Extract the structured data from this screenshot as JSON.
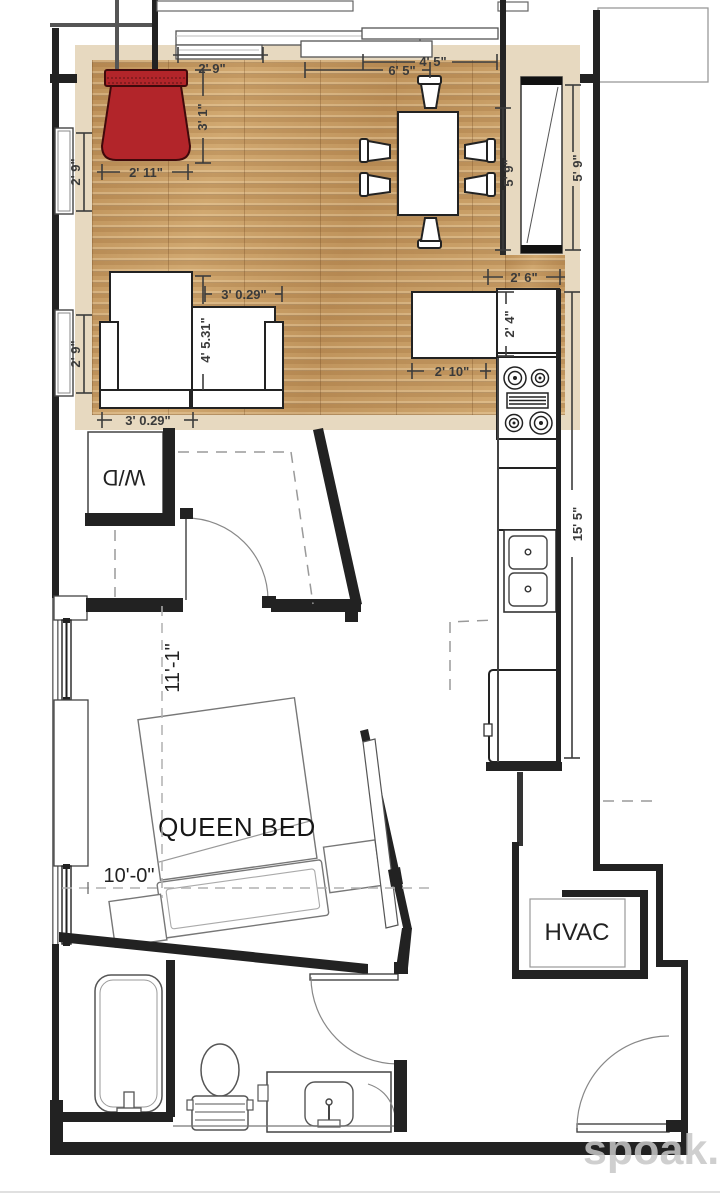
{
  "watermark": "spoak.",
  "labels": {
    "bed": "QUEEN BED",
    "laundry": "W/D",
    "hvac": "HVAC"
  },
  "dimensions": {
    "top_window": "2' 9\"",
    "red_chair_height": "3' 1\"",
    "red_chair_width": "2' 11\"",
    "left_window_upper": "2' 9\"",
    "left_window_lower": "2' 9\"",
    "dining_span_a": "6' 5\"",
    "dining_span_b": "4' 5\"",
    "dining_depth": "5' 9\"",
    "shelf_height": "5' 9\"",
    "counter_width": "2' 6\"",
    "counter_depth": "2' 4\"",
    "island_width": "2' 10\"",
    "armchair_width_top": "3' 0.29\"",
    "armchair_height": "4' 5.31\"",
    "armchair_width_bottom": "3' 0.29\"",
    "kitchen_run": "15' 5\"",
    "bedroom_length": "11'-1\"",
    "bedroom_width": "10'-0\""
  },
  "colors": {
    "accent_red": "#b2252a",
    "wood": "#c89e66",
    "overlay_beige": "#e7d9c0",
    "wall": "#222222",
    "watermark_gray": "#c7c7c7"
  }
}
